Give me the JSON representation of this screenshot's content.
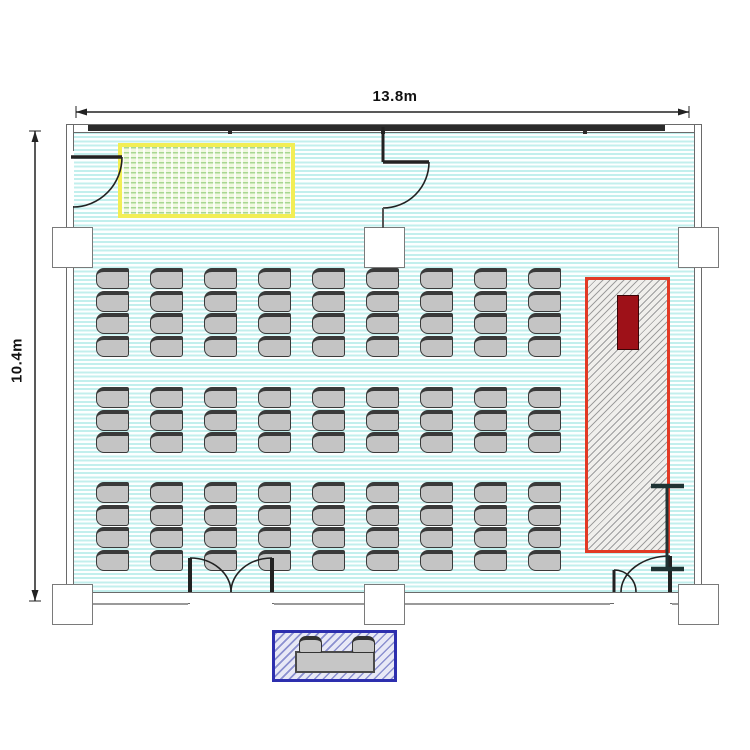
{
  "plan": {
    "type": "room-floor-plan",
    "dimensions": {
      "width_label": "13.8m",
      "height_label": "10.4m"
    },
    "seating": {
      "columns": 9,
      "row_bands": [
        4,
        3,
        4
      ],
      "total_seats": 99
    },
    "reception": {
      "tables": 1,
      "chairs": 2
    },
    "features": {
      "screen_area": "yellow-hatched-area-top-left",
      "stage_area": "red-hatched-stage-right",
      "stage_equipment": "dark-red-lectern",
      "stand_marker": "i-beam-stand",
      "reception_area": "blue-hatched-reception-table-bottom",
      "window_wall": "top",
      "columns": 6,
      "doors": [
        "left-wall-single-door",
        "partition-single-door",
        "bottom-double-door",
        "bottom-right-unequal-double-door"
      ]
    },
    "colors": {
      "floor_stripe": "#c2efed",
      "chair_fill": "#c4c4c4",
      "chair_border": "#3a3a3a",
      "screen_border": "#f2ee55",
      "screen_hatch": "#a8d792",
      "stage_border": "#e23a25",
      "stage_inner_box": "#9e1118",
      "reception_border": "#2d2fae",
      "wall": "#6a6a6a",
      "window_band": "#2b2b2b"
    },
    "geometry": {
      "chair_grid": {
        "col_start": 96,
        "col_pitch": 54,
        "chair_w": 33,
        "chair_h": 21,
        "row_pitch": 22.5,
        "band_tops": [
          268,
          387,
          482
        ]
      },
      "reception_chairs": [
        {
          "x": 299,
          "y": 636
        },
        {
          "x": 352,
          "y": 636
        }
      ]
    }
  }
}
